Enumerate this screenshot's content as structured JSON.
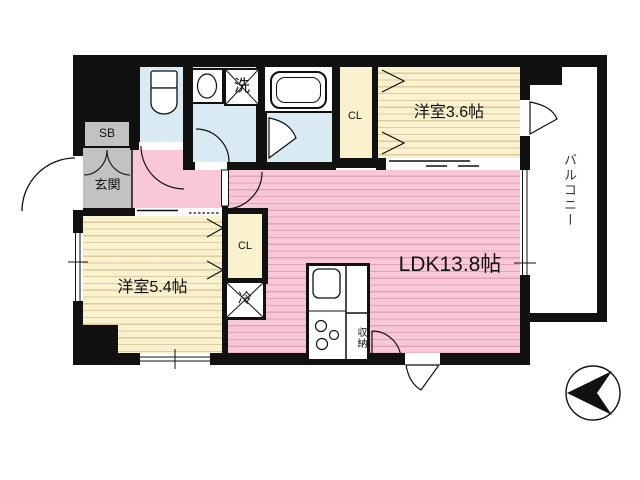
{
  "rooms": {
    "ldk": "LDK13.8帖",
    "western_room_3_6": "洋室3.6帖",
    "western_room_5_4": "洋室5.4帖",
    "balcony": "バルコニー",
    "entrance": "玄関",
    "shoe_box": "SB",
    "closet_upper": "CL",
    "closet_lower": "CL",
    "laundry": "洗",
    "refrigerator": "冷",
    "storage": "収納"
  },
  "icons": {
    "compass": "north-arrow-pointing-left",
    "toilet": "toilet-icon",
    "bathtub": "bathtub-icon",
    "sink": "kitchen-sink-icon",
    "stove": "gas-stove-icon",
    "washbasin": "washbasin-icon"
  },
  "colors": {
    "wall": "#111111",
    "ldk_pink": "#F8C8D8",
    "ldk_pink_line": "#E0A2BB",
    "room_cream": "#FAF2CE",
    "room_cream_line": "#DBCB9E",
    "wet_area_blue": "#D9EAF2",
    "entrance_gray": "#C2C2C2",
    "balcony_white": "#FFFFFF",
    "text": "#111111"
  }
}
